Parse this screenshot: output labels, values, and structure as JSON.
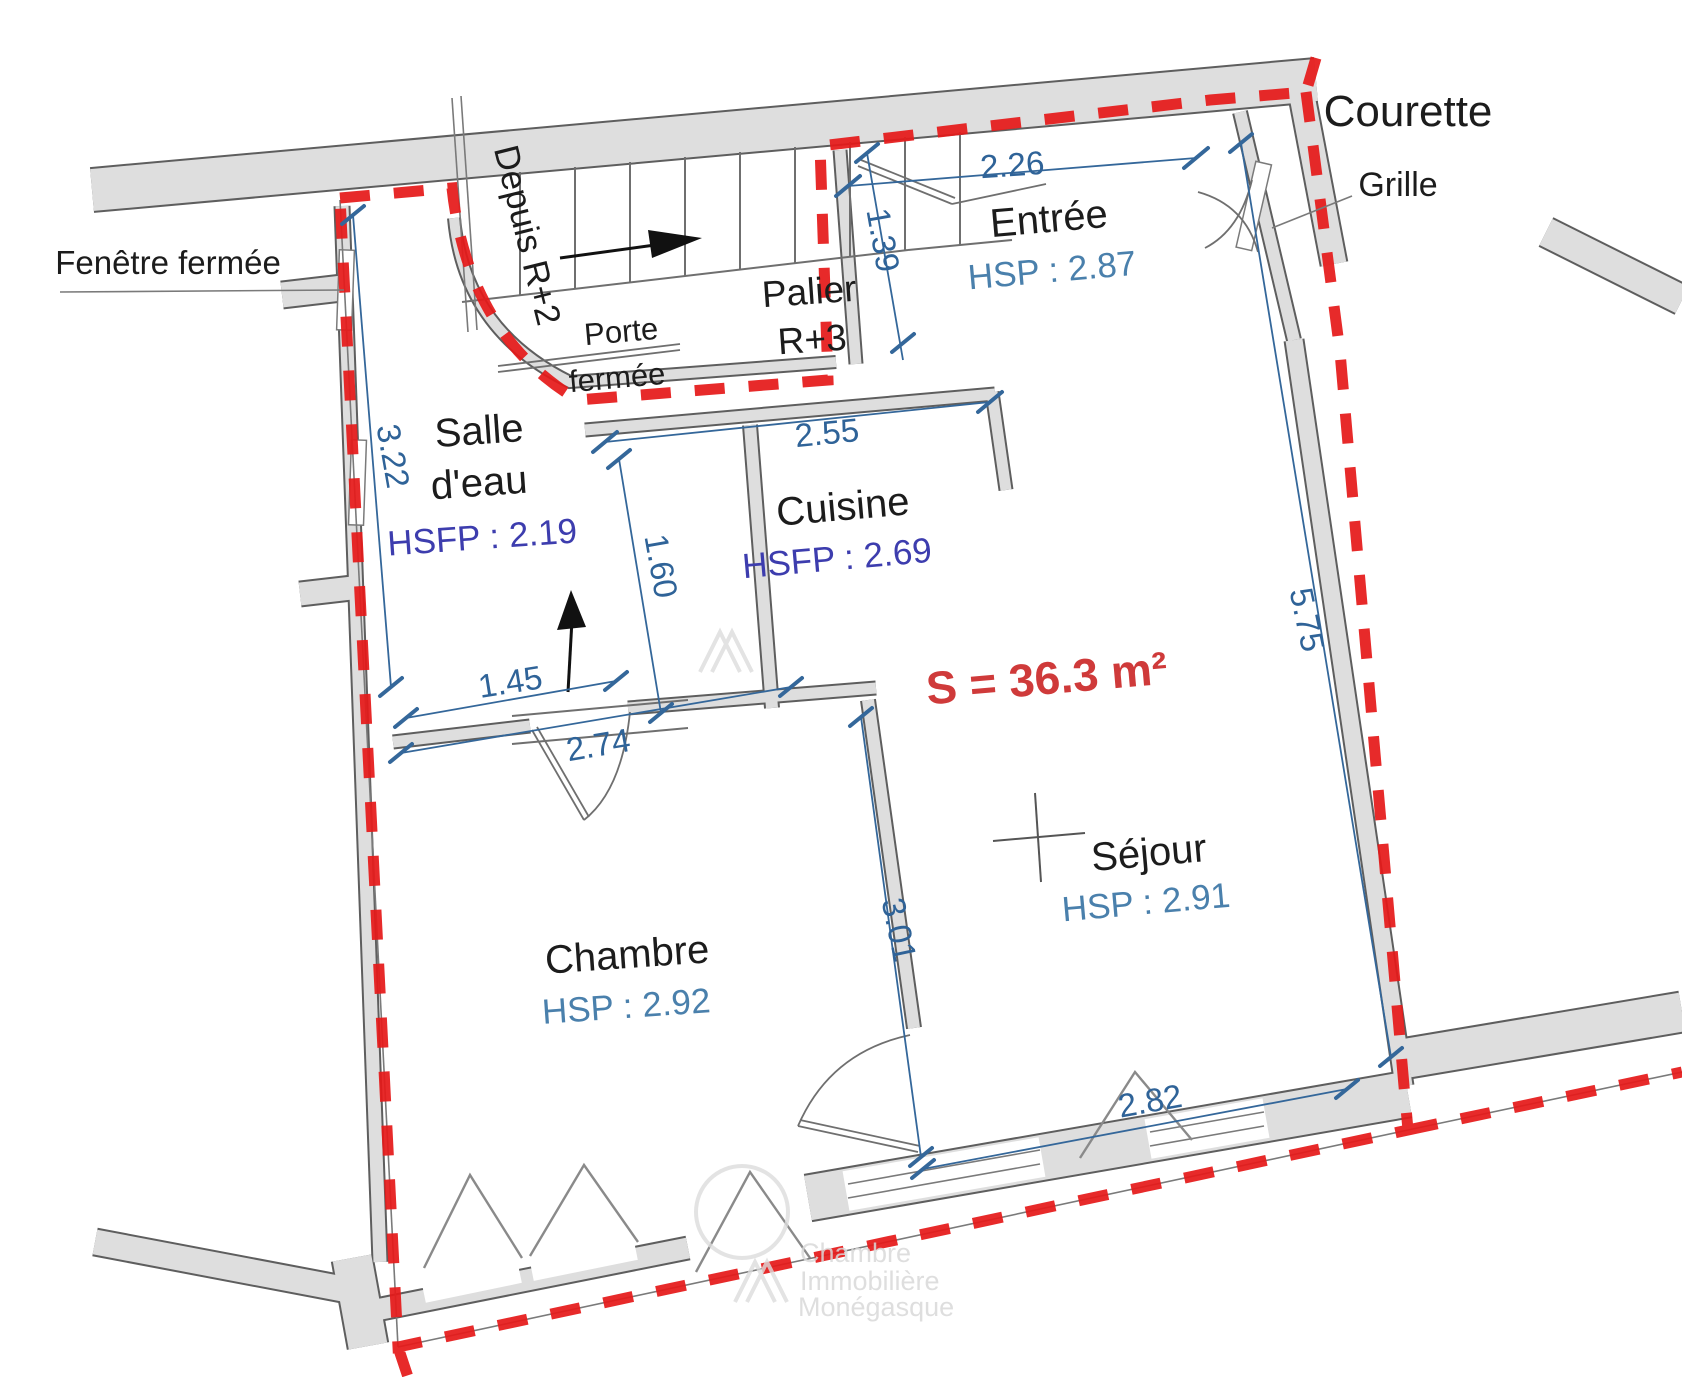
{
  "plan": {
    "surface_label": "S = 36.3 m²"
  },
  "rooms": {
    "entree": {
      "name": "Entrée",
      "height": "HSP : 2.87"
    },
    "cuisine": {
      "name": "Cuisine",
      "height": "HSFP : 2.69"
    },
    "salle_eau": {
      "name_line1": "Salle",
      "name_line2": "d'eau",
      "height": "HSFP : 2.19"
    },
    "sejour": {
      "name": "Séjour",
      "height": "HSP : 2.91"
    },
    "chambre": {
      "name": "Chambre",
      "height": "HSP : 2.92"
    },
    "palier": {
      "line1": "Palier",
      "line2": "R+3"
    }
  },
  "annotations": {
    "courette": "Courette",
    "grille": "Grille",
    "fenetre_fermee": "Fenêtre fermée",
    "porte_fermee_line1": "Porte",
    "porte_fermee_line2": "fermée",
    "depuis_r2": "Depuis R+2"
  },
  "dimensions": {
    "d226": "2.26",
    "d139": "1.39",
    "d255": "2.55",
    "d322": "3.22",
    "d160": "1.60",
    "d145": "1.45",
    "d274": "2.74",
    "d301": "3.01",
    "d575": "5.75",
    "d282": "2.82"
  },
  "watermark": {
    "line1": "Chambre",
    "line2": "Immobilière",
    "line3": "Monégasque"
  },
  "colors": {
    "boundary_red": "#e51a1a",
    "dimension_blue": "#34679a",
    "hsp_blue": "#4a80ac",
    "hsfp_indigo": "#3d3dae",
    "surface_red": "#cf3a3a",
    "wall_fill": "#dedede",
    "wall_edge": "#5e5e5e"
  }
}
